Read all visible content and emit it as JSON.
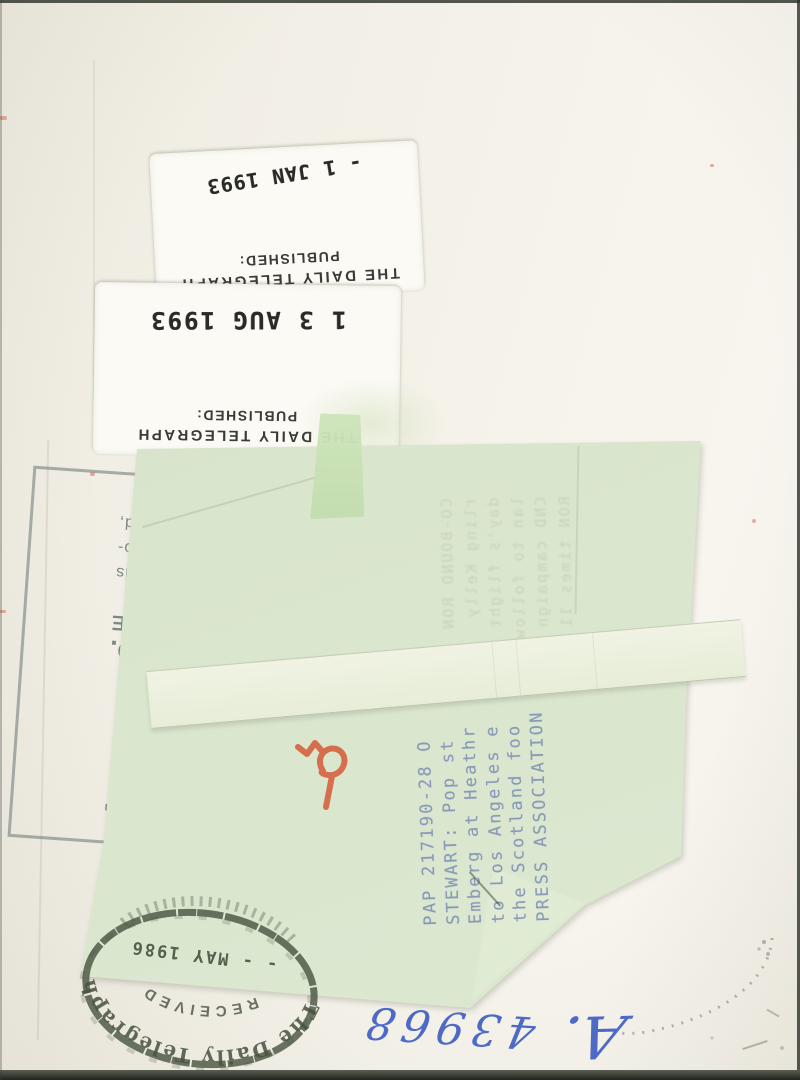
{
  "photo_back": {
    "stickers": [
      {
        "org": "THE DAILY TELEGRAPH",
        "label": "PUBLISHED:",
        "date_stamp": "- 1 JAN 1993"
      },
      {
        "org": "THE DAILY TELEGRAPH",
        "label": "PUBLISHED:",
        "date_stamp": "1 3 AUG 1993"
      }
    ],
    "copyright_stamp": {
      "fragments": [
        "IT",
        "LTD.",
        "4BE",
        "nce is",
        "photo-",
        "ued,"
      ]
    },
    "caption_sheet": {
      "typed_lines": [
        "PAP 217190-28 O",
        "STEWART: Pop st",
        "Emberg at Heathr",
        "to Los Angeles e",
        "the Scotland foo",
        "PRESS ASSOCIATION"
      ],
      "showthrough_lines": [
        "CO-BOUND RON",
        "rling Kelly",
        "day's flight",
        "lan to follow",
        "CND campaign",
        "RON times 11"
      ]
    },
    "received_stamp": {
      "org": "The Daily Telegraph",
      "status": "RECEIVED",
      "date": "- - MAY 1986"
    },
    "handwriting": {
      "prefix": "A.",
      "number": "43968"
    },
    "colors": {
      "paper": "#f2efe6",
      "caption_sheet": "#d9e5cc",
      "typewriter_ink": "#7d90b4",
      "stamp_ink": "#2a2a28",
      "received_ink": "#47523f",
      "pen_ink": "#3f5fc4",
      "crayon": "#d4512e"
    }
  }
}
